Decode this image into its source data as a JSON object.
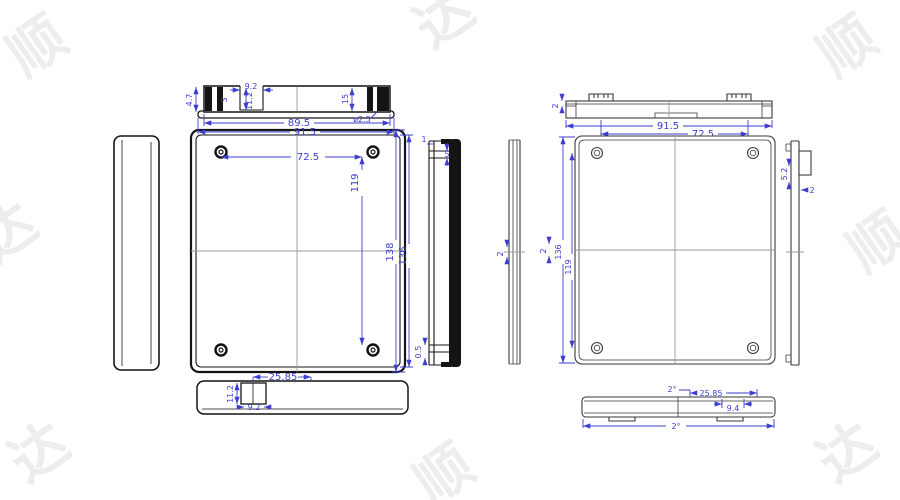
{
  "colors": {
    "background": "#ffffff",
    "dimension_blue": "#3d3dd2",
    "outline_dark": "#141414",
    "outline_light": "#3a3a3a",
    "centerline_gray": "#9a9a9a",
    "watermark_gray": "#ededed"
  },
  "watermark": {
    "chars": [
      "顺",
      "达",
      "顺",
      "达",
      "顺",
      "达",
      "顺",
      "达"
    ]
  },
  "dims": {
    "left_top_profile": {
      "height_4_7": "4.7",
      "gap_3": "3",
      "width_9_2": "9.2",
      "depth_11_2": "11.2",
      "height_15": "15",
      "hole_dia": "ø2.5",
      "width_89_5": "89.5",
      "width_91_5": "91.5"
    },
    "left_plan": {
      "hole_span_x": "72.5",
      "hole_span_y": "119",
      "height_outer": "138",
      "height_inner": "136"
    },
    "left_section": {
      "lip_1": "1",
      "gap_5": "5",
      "gap_0_5": "0.5"
    },
    "left_bottom": {
      "offset_25_85": "25.85",
      "depth_11_2": "11.2",
      "width_9_2": "9.2"
    },
    "right_top_profile": {
      "wall_2": "2",
      "width_91_5": "91.5",
      "tab_span_72_5": "72.5"
    },
    "right_section": {
      "wall_2": "2"
    },
    "right_plan": {
      "wall_2": "2",
      "height_136": "136",
      "hole_span_y": "119"
    },
    "right_side": {
      "tab_5_2": "5.2",
      "wall_2": "2"
    },
    "right_bottom": {
      "draft_top": "2°",
      "offset_25_85": "25.85",
      "width_9_4": "9.4",
      "draft_bottom": "2°"
    }
  }
}
